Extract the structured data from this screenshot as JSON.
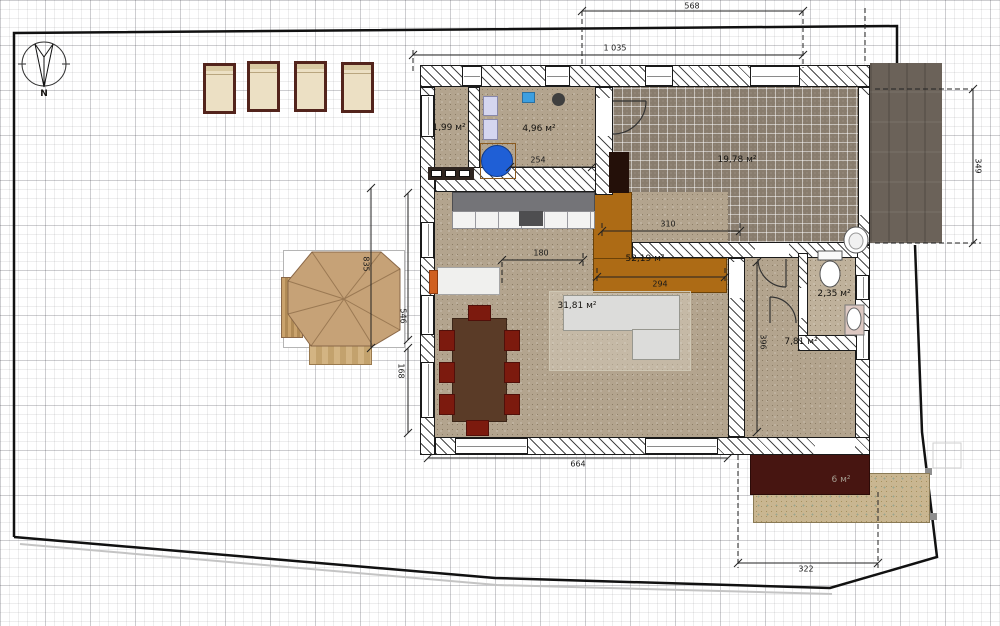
{
  "plan": {
    "compass": {
      "label": "N"
    },
    "rooms": {
      "storage": "1,99 м²",
      "laundry": "4,96 м²",
      "terrace": "19,78 м²",
      "ground_total": "52,19 м²",
      "living": "31,81 м²",
      "wc": "2,35 м²",
      "hall": "7,81 м²",
      "porch": "6 м²"
    },
    "dimensions": {
      "site_top": "568",
      "site_top_full": "1 035",
      "laundry_w": "254",
      "terrace_w": "310",
      "kitchen_w": "180",
      "stair_w": "294",
      "west_h": "835",
      "patio_h": "546",
      "deck_h": "168",
      "south_w": "664",
      "hall_h": "396",
      "garage_h": "349",
      "porch_w": "322"
    },
    "colors": {
      "stairs_orange": "#ad6b15",
      "floor_speckle": "#b3a48e",
      "terrace_tile": "#897d6e",
      "garage_gray": "#6b6259",
      "porch_maroon": "#471511",
      "paving_tan": "#c9b691",
      "gazebo_tan": "#c6a277",
      "table_brown": "#5a3b27",
      "chair_red": "#7c1a0e",
      "appliance_blue": "#1f5fd6",
      "boundary_black": "#111111"
    }
  }
}
